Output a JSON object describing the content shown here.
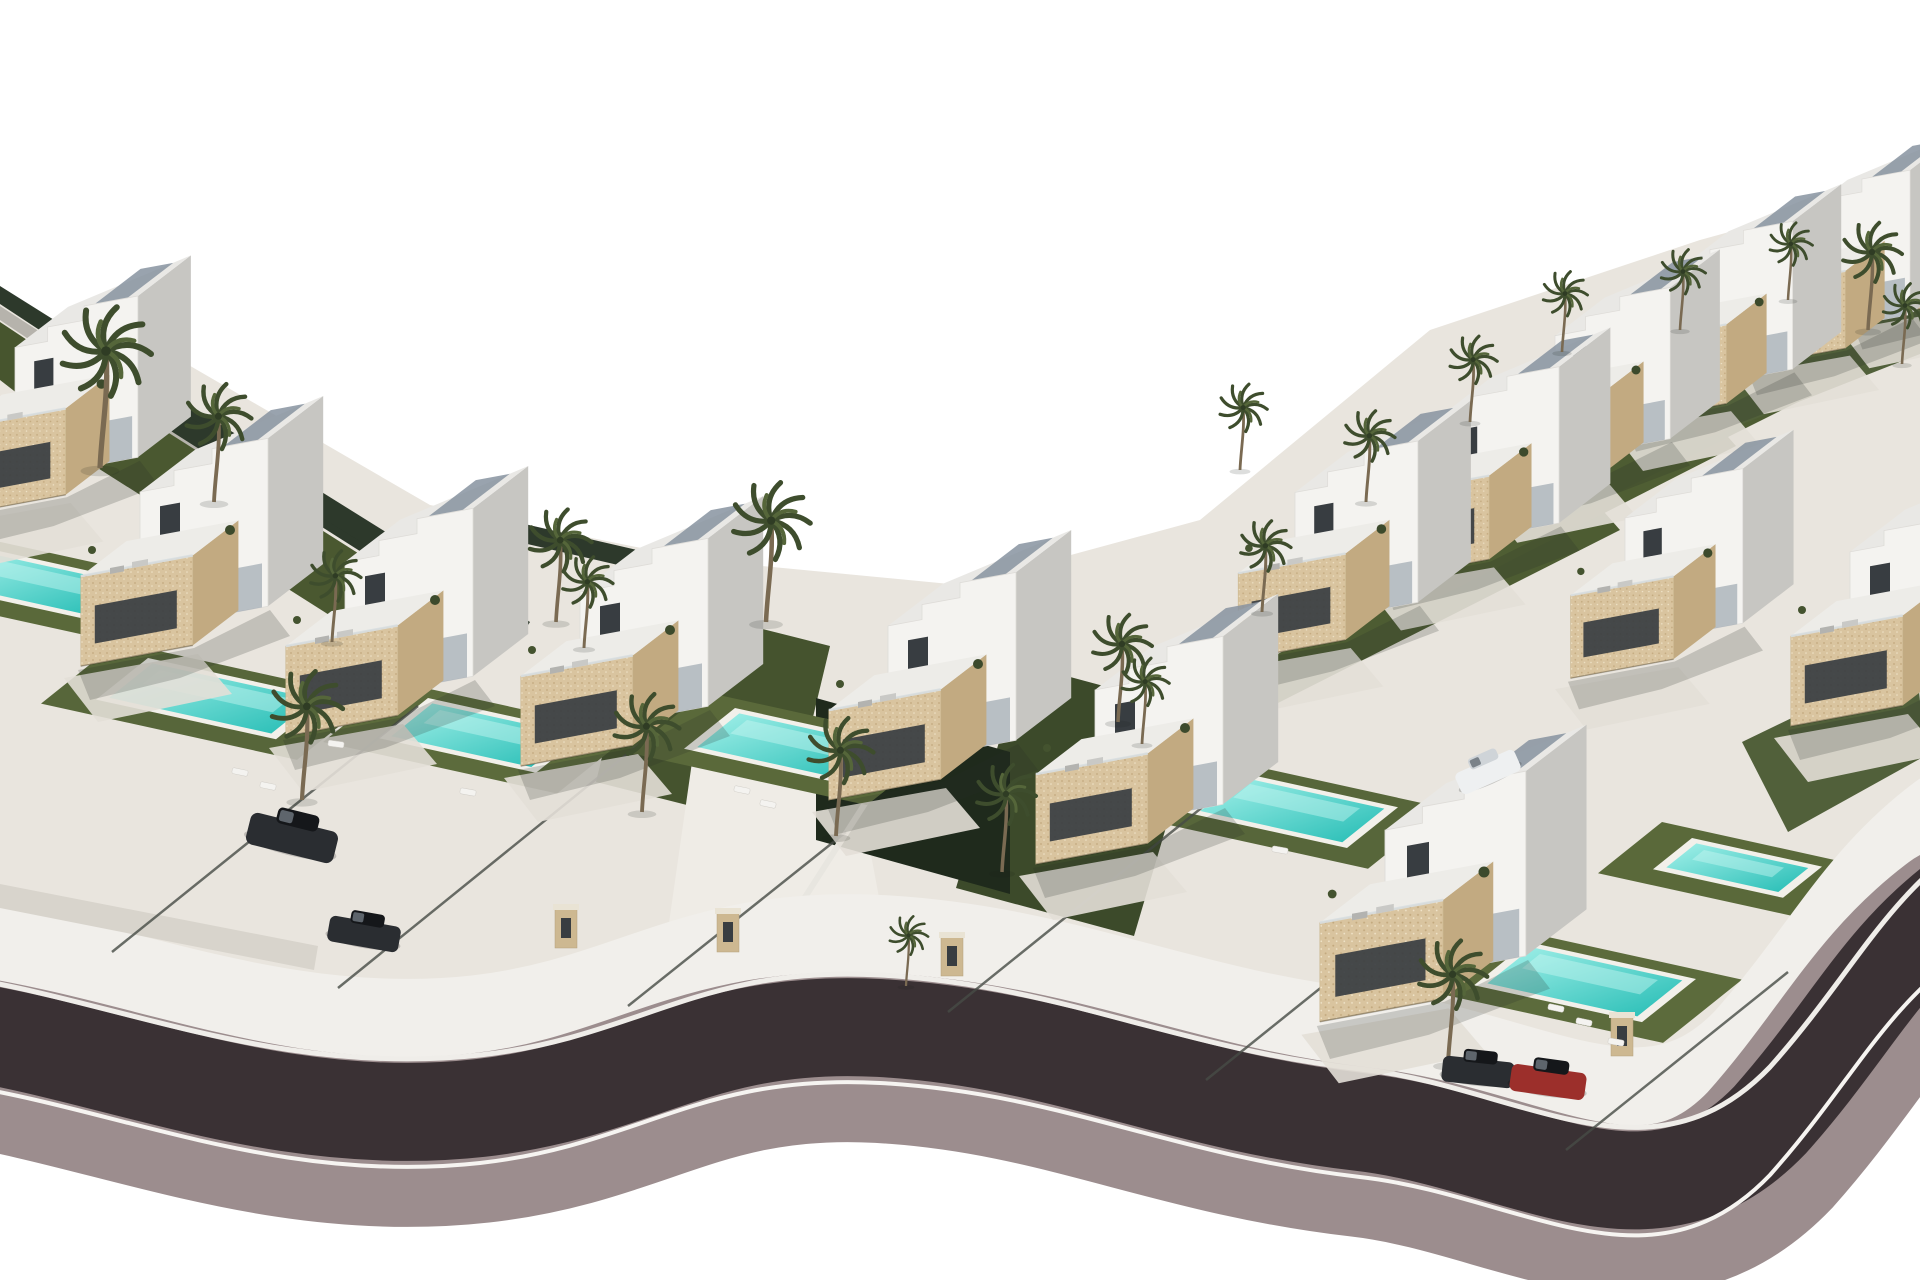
{
  "scene": {
    "width": 1920,
    "height": 1280,
    "label": "aerial-3d-render-villa-development",
    "background": "#ffffff"
  },
  "palette": {
    "background": "#ffffff",
    "ground_paving": "#e9e5de",
    "drive_paving": "#f0ede7",
    "road_asphalt": "#3a3134",
    "road_curb": "#9c8d8e",
    "sidewalk": "#f1efeb",
    "curb_line_top": "#efede9",
    "curb_line_bottom": "#f6f4f1",
    "villa_white": "#f4f3f0",
    "villa_shade": "#c7c6c2",
    "roof_top": "#e9e8e5",
    "stone": "#d9c49f",
    "stone_shade": "#c2aa81",
    "window_dark": "#383d41",
    "glass": "#8793a0",
    "rail": "#d9dfe2",
    "lawn_mid": "#57663a",
    "lawn_dark": "#3e4c2b",
    "lawn_shadow": "#1f2a1c",
    "hedge_dark": "#2d392b",
    "wall_grey": "#b6b3ac",
    "low_wall": "#d8d4cc",
    "fence": "#474c46",
    "pool_deck": "#f2f0ea",
    "pool_deep": "#23bcb4",
    "pool_light": "#a5f1ea",
    "pool_ripple": "#c9f6f1",
    "palm_trunk": "#7a6a52",
    "palm_frond": "#3e4d2d",
    "palm_frond_light": "#55663a",
    "car_dark": "#2a2d31",
    "car_red": "#9c2f2b",
    "car_white": "#eef0f1",
    "post_stone": "#cdb891",
    "post_cap": "#e9e3d4",
    "shadow": "rgba(40,45,40,0.20)"
  },
  "ground": {
    "path": "M -10 300 L 180 360 L 430 505 L 700 560 L 960 585 L 1200 520 L 1430 330 L 1700 240 L 1925 178 L 1925 1010 L 1760 1120 L 1600 1150 L 1380 1100 L 1100 1035 L 880 1000 L 640 1065 L 430 1080 L 200 1040 L -10 1000 Z"
  },
  "road": {
    "path": "M -40 1030 C 120 1055 280 1130 480 1108 C 640 1090 700 1018 880 1028 C 1060 1038 1170 1100 1360 1122 C 1520 1140 1650 1245 1770 1120 C 1850 1030 1880 960 1960 900",
    "layers": [
      {
        "name": "sidewalk-upper",
        "w": 150,
        "dy": -58,
        "colorKey": "sidewalk"
      },
      {
        "name": "curb-band",
        "w": 170,
        "dy": 30,
        "colorKey": "road_curb"
      },
      {
        "name": "asphalt",
        "w": 98,
        "dy": 0,
        "colorKey": "road_asphalt"
      },
      {
        "name": "curb-line-top",
        "w": 5,
        "dy": -53,
        "colorKey": "curb_line_top"
      },
      {
        "name": "curb-line-bottom",
        "w": 4,
        "dy": 55,
        "colorKey": "curb_line_bottom"
      }
    ]
  },
  "bands": [
    {
      "n": "hedge-strip",
      "pts": [
        [
          0,
          286
        ],
        [
          258,
          448
        ],
        [
          246,
          466
        ],
        [
          0,
          304
        ]
      ],
      "c": "#2d392b"
    },
    {
      "n": "wall-strip",
      "pts": [
        [
          0,
          306
        ],
        [
          250,
          468
        ],
        [
          242,
          482
        ],
        [
          0,
          320
        ]
      ],
      "c": "#b6b3ac"
    },
    {
      "n": "lawn-strip",
      "pts": [
        [
          0,
          322
        ],
        [
          244,
          484
        ],
        [
          206,
          540
        ],
        [
          0,
          380
        ]
      ],
      "c": "#47552e"
    },
    {
      "n": "hedge-strip",
      "pts": [
        [
          112,
          368
        ],
        [
          408,
          556
        ],
        [
          396,
          574
        ],
        [
          100,
          386
        ]
      ],
      "c": "#2d392b"
    },
    {
      "n": "lawn-strip",
      "pts": [
        [
          98,
          388
        ],
        [
          394,
          576
        ],
        [
          356,
          632
        ],
        [
          60,
          444
        ]
      ],
      "c": "#4a5830"
    },
    {
      "n": "hedge-strip",
      "pts": [
        [
          248,
          446
        ],
        [
          530,
          622
        ],
        [
          518,
          640
        ],
        [
          236,
          464
        ]
      ],
      "c": "#2d392b"
    },
    {
      "n": "hedge-strip",
      "pts": [
        [
          516,
          522
        ],
        [
          706,
          566
        ],
        [
          700,
          584
        ],
        [
          510,
          540
        ]
      ],
      "c": "#2d392b"
    },
    {
      "n": "hedge-strip",
      "pts": [
        [
          1238,
          652
        ],
        [
          1588,
          476
        ],
        [
          1596,
          492
        ],
        [
          1246,
          668
        ]
      ],
      "c": "#2d392b"
    },
    {
      "n": "lawn-strip",
      "pts": [
        [
          1246,
          670
        ],
        [
          1590,
          496
        ],
        [
          1620,
          530
        ],
        [
          1276,
          704
        ]
      ],
      "c": "#4d5c32"
    },
    {
      "n": "hedge-strip",
      "pts": [
        [
          1368,
          560
        ],
        [
          1700,
          392
        ],
        [
          1708,
          408
        ],
        [
          1376,
          576
        ]
      ],
      "c": "#2d392b"
    },
    {
      "n": "lawn-strip",
      "pts": [
        [
          1380,
          578
        ],
        [
          1706,
          412
        ],
        [
          1736,
          446
        ],
        [
          1410,
          612
        ]
      ],
      "c": "#4f5e33"
    },
    {
      "n": "hedge-strip",
      "pts": [
        [
          1518,
          470
        ],
        [
          1830,
          314
        ],
        [
          1838,
          330
        ],
        [
          1526,
          486
        ]
      ],
      "c": "#2d392b"
    },
    {
      "n": "lawn-strip",
      "pts": [
        [
          1528,
          488
        ],
        [
          1840,
          332
        ],
        [
          1870,
          366
        ],
        [
          1558,
          522
        ]
      ],
      "c": "#4d5c32"
    },
    {
      "n": "hedge-strip",
      "pts": [
        [
          1660,
          388
        ],
        [
          1920,
          258
        ],
        [
          1925,
          276
        ],
        [
          1668,
          404
        ]
      ],
      "c": "#2d392b"
    },
    {
      "n": "lawn-strip",
      "pts": [
        [
          1672,
          406
        ],
        [
          1925,
          282
        ],
        [
          1925,
          352
        ],
        [
          1702,
          440
        ]
      ],
      "c": "#51603a"
    },
    {
      "n": "lawn-strip",
      "pts": [
        [
          640,
          598
        ],
        [
          830,
          646
        ],
        [
          786,
          830
        ],
        [
          596,
          782
        ]
      ],
      "c": "#45532e"
    },
    {
      "n": "lawn-strip",
      "pts": [
        [
          1022,
          664
        ],
        [
          1200,
          712
        ],
        [
          1134,
          936
        ],
        [
          956,
          888
        ]
      ],
      "c": "#3c4a2a"
    },
    {
      "n": "lawn-strip",
      "pts": [
        [
          1128,
          958
        ],
        [
          1318,
          1012
        ],
        [
          1286,
          1122
        ],
        [
          1096,
          1066
        ]
      ],
      "c": "#57663a"
    },
    {
      "n": "lawn-strip",
      "pts": [
        [
          1742,
          742
        ],
        [
          1916,
          658
        ],
        [
          1925,
          756
        ],
        [
          1788,
          832
        ]
      ],
      "c": "#51603a"
    },
    {
      "n": "driveway",
      "pts": [
        [
          700,
          706
        ],
        [
          850,
          742
        ],
        [
          900,
          1010
        ],
        [
          660,
          986
        ]
      ],
      "c": "#efece6"
    },
    {
      "n": "shaded-lawn-arch",
      "pts": [
        [
          816,
          698
        ],
        [
          1010,
          752
        ],
        [
          1010,
          894
        ],
        [
          816,
          840
        ]
      ],
      "c": "#1f2a1c"
    }
  ],
  "path_lines": [
    {
      "n": "garden-path",
      "x1": 930,
      "y1": 702,
      "x2": 800,
      "y2": 905,
      "w": 6,
      "c": "#e8e6e0"
    }
  ],
  "walls": [
    {
      "n": "low-wall",
      "pts": [
        [
          0,
          884
        ],
        [
          318,
          946
        ],
        [
          314,
          970
        ],
        [
          0,
          908
        ]
      ],
      "c": "#d8d4cc"
    }
  ],
  "fences": [
    [
      112,
      952,
      418,
      706
    ],
    [
      338,
      988,
      642,
      742
    ],
    [
      628,
      1006,
      846,
      832
    ],
    [
      948,
      1012,
      1256,
      764
    ],
    [
      1206,
      1080,
      1430,
      900
    ],
    [
      1566,
      1150,
      1788,
      972
    ]
  ],
  "pools": [
    {
      "x": -15,
      "y": 548,
      "L": 150,
      "D": 96
    },
    {
      "x": 148,
      "y": 658,
      "L": 180,
      "D": 104
    },
    {
      "x": 428,
      "y": 698,
      "L": 158,
      "D": 100
    },
    {
      "x": 735,
      "y": 708,
      "L": 162,
      "D": 102
    },
    {
      "x": 1238,
      "y": 772,
      "L": 160,
      "D": 102
    },
    {
      "x": 1528,
      "y": 942,
      "L": 168,
      "D": 108
    },
    {
      "x": 1692,
      "y": 838,
      "L": 130,
      "D": 78
    }
  ],
  "villas": [
    {
      "x": 1905,
      "y": 290,
      "s": 0.85
    },
    {
      "x": 1800,
      "y": 335,
      "s": 0.86
    },
    {
      "x": 1680,
      "y": 390,
      "s": 0.88
    },
    {
      "x": 1555,
      "y": 460,
      "s": 0.9
    },
    {
      "x": 15,
      "y": 480,
      "s": 0.96
    },
    {
      "x": 1440,
      "y": 545,
      "s": 0.93
    },
    {
      "x": 1295,
      "y": 625,
      "s": 0.96
    },
    {
      "x": 140,
      "y": 630,
      "s": 1.0
    },
    {
      "x": 1625,
      "y": 645,
      "s": 0.92
    },
    {
      "x": 1850,
      "y": 690,
      "s": 1.0
    },
    {
      "x": 345,
      "y": 700,
      "s": 1.0
    },
    {
      "x": 580,
      "y": 730,
      "s": 1.0
    },
    {
      "x": 888,
      "y": 764,
      "s": 1.0
    },
    {
      "x": 1095,
      "y": 828,
      "s": 1.0
    },
    {
      "x": 1385,
      "y": 982,
      "s": 1.1
    }
  ],
  "palms": [
    [
      100,
      468,
      1.5
    ],
    [
      214,
      502,
      1.1
    ],
    [
      332,
      642,
      0.85
    ],
    [
      556,
      622,
      1.05
    ],
    [
      584,
      648,
      0.85
    ],
    [
      766,
      622,
      1.3
    ],
    [
      302,
      800,
      1.2
    ],
    [
      642,
      812,
      1.1
    ],
    [
      836,
      836,
      1.1
    ],
    [
      1002,
      872,
      1.0
    ],
    [
      1118,
      722,
      1.0
    ],
    [
      1142,
      744,
      0.8
    ],
    [
      1262,
      612,
      0.85
    ],
    [
      1366,
      502,
      0.85
    ],
    [
      1470,
      422,
      0.8
    ],
    [
      1562,
      352,
      0.75
    ],
    [
      1680,
      330,
      0.75
    ],
    [
      1788,
      300,
      0.72
    ],
    [
      1868,
      330,
      1.0
    ],
    [
      1902,
      364,
      0.75
    ],
    [
      1448,
      1064,
      1.15
    ],
    [
      906,
      986,
      0.65
    ],
    [
      1240,
      470,
      0.8
    ]
  ],
  "cars": [
    {
      "x": 292,
      "y": 838,
      "a": 14,
      "c": "dark",
      "s": 1.25
    },
    {
      "x": 364,
      "y": 934,
      "a": 10,
      "c": "dark",
      "s": 1.0
    },
    {
      "x": 1488,
      "y": 772,
      "a": -24,
      "c": "white",
      "s": 0.9
    },
    {
      "x": 1478,
      "y": 1072,
      "a": 6,
      "c": "dark",
      "s": 1.0
    },
    {
      "x": 1548,
      "y": 1082,
      "a": 8,
      "c": "red",
      "s": 1.05
    }
  ],
  "gateposts": [
    [
      566,
      948
    ],
    [
      728,
      952
    ],
    [
      952,
      976
    ],
    [
      1412,
      982
    ],
    [
      1622,
      1056
    ]
  ],
  "loungers": [
    [
      240,
      772,
      12
    ],
    [
      268,
      786,
      12
    ],
    [
      468,
      792,
      10
    ],
    [
      742,
      790,
      12
    ],
    [
      768,
      804,
      12
    ],
    [
      1280,
      850,
      10
    ],
    [
      1556,
      1008,
      12
    ],
    [
      1584,
      1022,
      12
    ],
    [
      336,
      744,
      8
    ],
    [
      1616,
      1042,
      10
    ]
  ]
}
